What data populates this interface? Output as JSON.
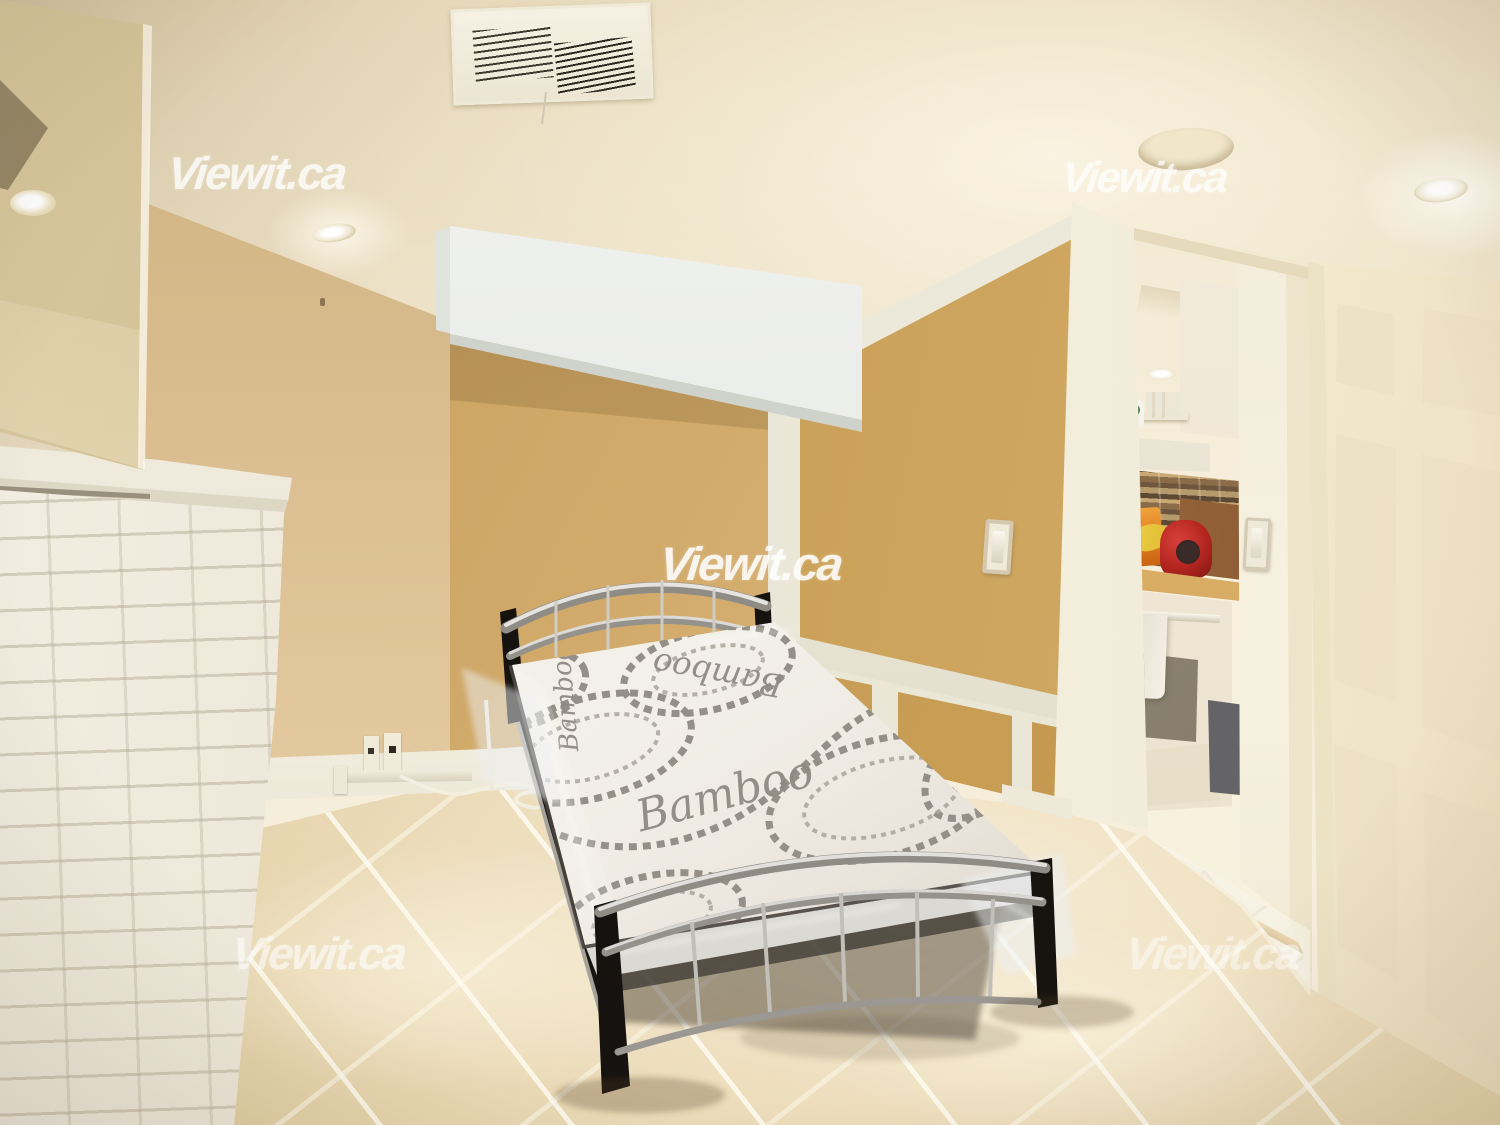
{
  "scene": {
    "type": "real-estate interior photograph",
    "description": "Basement bedroom with metal bed and plastic-wrapped mattress, white brick fireplace with mirror, tan walls, tiled floor, doorway to kitchen with white stove, and open white panel door"
  },
  "watermark": {
    "text": "Viewit.ca"
  },
  "mattress": {
    "label": "Bamboo"
  },
  "palette": {
    "ceiling": "#f2e9d4",
    "wall_tan_light": "#dcc094",
    "wall_tan_dark": "#c3974e",
    "trim_white": "#efece0",
    "bulkhead_white": "#eceeea",
    "floor_tile": "#ecdcba",
    "grout": "#f7efdc",
    "door_cream": "#f4ebd3",
    "fireplace_white": "#efe9db",
    "bed_silver": "#b7b4ae",
    "bed_black": "#1a1715",
    "mattress_white": "#f2efe8",
    "pattern_gray": "#8d8880",
    "kettle_red": "#b3251f",
    "banana_yellow": "#e6c23c",
    "backsplash_brown": "#7c5f41",
    "stove_white": "#f3ecdc"
  }
}
